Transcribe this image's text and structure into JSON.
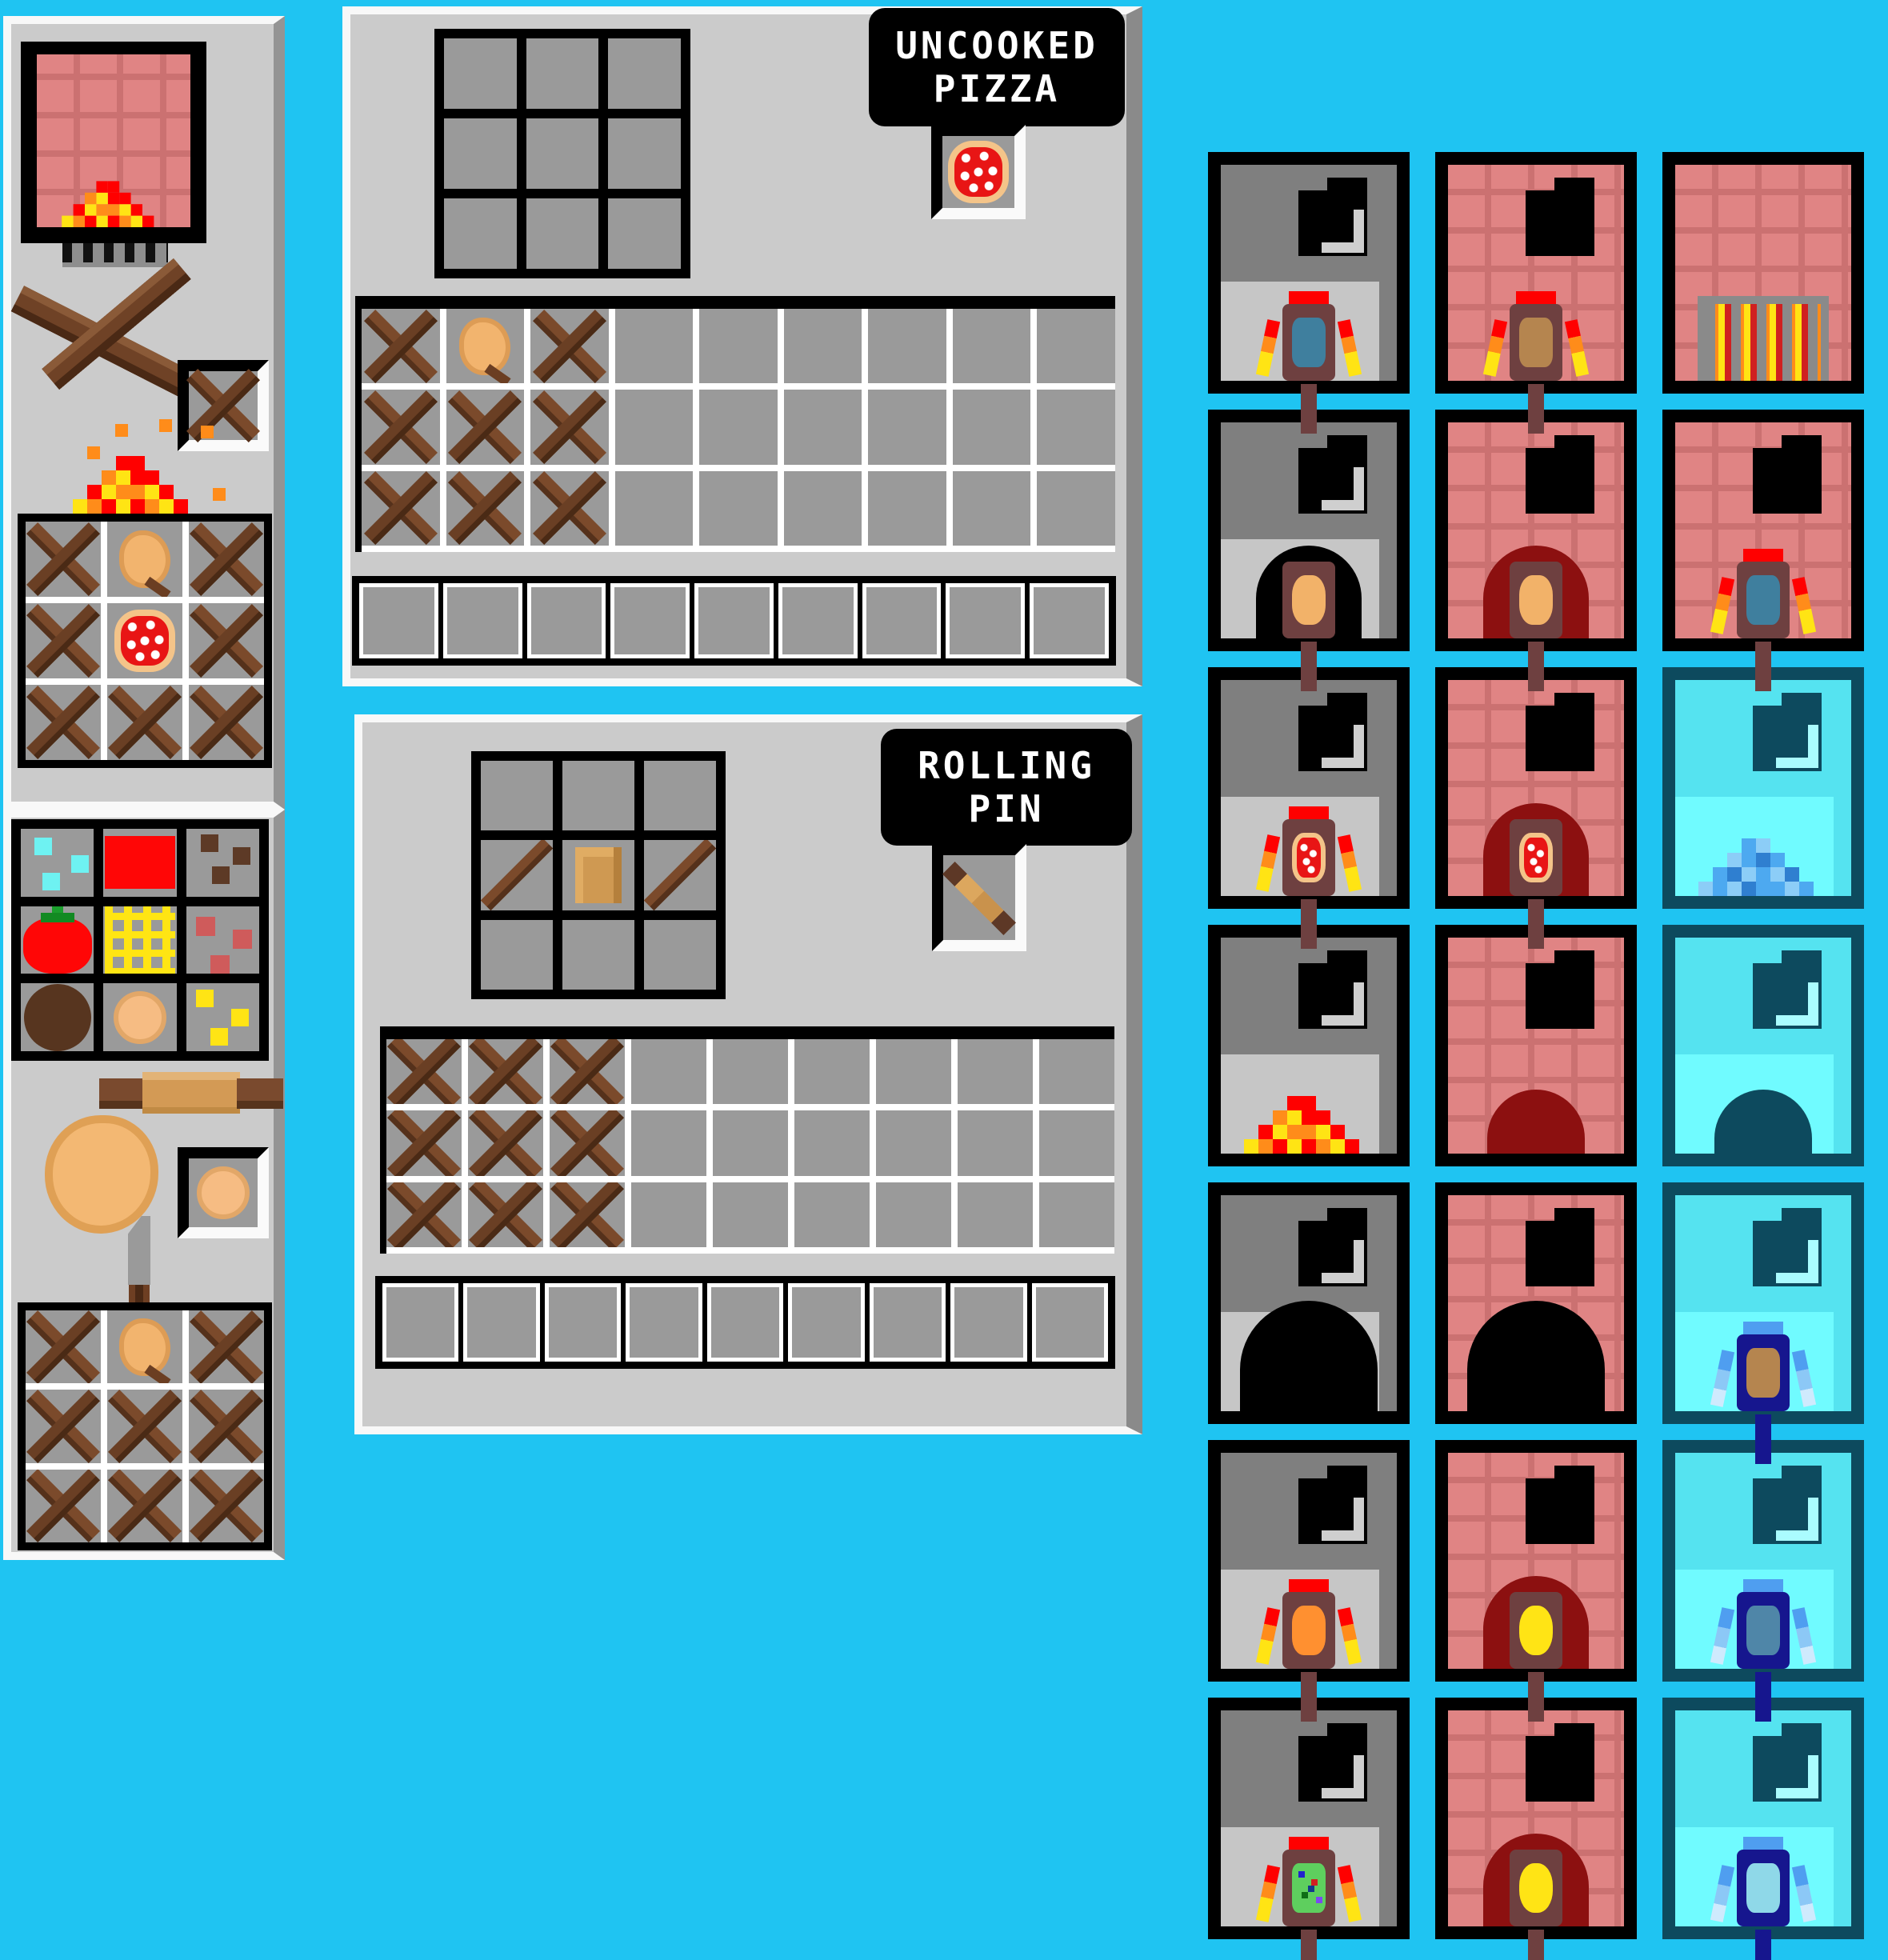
{
  "colors": {
    "background": "#1fc4f2",
    "panel": "#cbcbcb",
    "panel_border_light": "#f8f8f8",
    "panel_shadow": "#949494",
    "slot_gray": "#9a9a9a",
    "brick_body": "#e08484",
    "brick_grout": "#cb7171",
    "fire_red": "#ff0000",
    "fire_orange": "#ff8c1a",
    "fire_yellow": "#ffe414",
    "ice_body": "#55e3f0",
    "ice_frame": "#0d4a5e",
    "navy_paddle": "#16168e",
    "paddle_brown": "#6e4040",
    "maroon_arch": "#8c1010"
  },
  "labels": {
    "pizza_line1": "UNCOOKED",
    "pizza_line2": "PIZZA",
    "pin_line1": "ROLLING",
    "pin_line2": "PIN"
  },
  "left_top_panel": {
    "art": [
      "pizza-oven-with-fire",
      "firewood-sticks",
      "fire"
    ],
    "slot_item": "stick",
    "grid": [
      [
        "stick",
        "dough",
        "stick"
      ],
      [
        "stick",
        "pizza",
        "stick"
      ],
      [
        "stick",
        "stick",
        "stick"
      ]
    ]
  },
  "left_bottom_panel": {
    "ingredients": [
      [
        "cyan-specks",
        "sauce",
        "brown-specks"
      ],
      [
        "tomato",
        "cheese",
        "pepperoni"
      ],
      [
        "chocolate",
        "dough-ball",
        "cheese-bits"
      ]
    ],
    "art": [
      "rolling-pin",
      "dough-blob",
      "knife"
    ],
    "slot_item": "dough-ball",
    "grid": [
      [
        "stick",
        "dough",
        "stick"
      ],
      [
        "stick",
        "stick",
        "stick"
      ],
      [
        "stick",
        "stick",
        "stick"
      ]
    ]
  },
  "pizza_panel": {
    "label": [
      "UNCOOKED",
      "PIZZA"
    ],
    "craft_grid": [
      [
        "",
        "",
        ""
      ],
      [
        "",
        "",
        ""
      ],
      [
        "",
        "",
        ""
      ]
    ],
    "output_item": "pizza",
    "inventory": [
      [
        "stick",
        "dough",
        "stick",
        "",
        "",
        "",
        "",
        "",
        ""
      ],
      [
        "stick",
        "stick",
        "stick",
        "",
        "",
        "",
        "",
        "",
        ""
      ],
      [
        "stick",
        "stick",
        "stick",
        "",
        "",
        "",
        "",
        "",
        ""
      ]
    ],
    "hotbar": [
      "",
      "",
      "",
      "",
      "",
      "",
      "",
      "",
      ""
    ]
  },
  "pin_panel": {
    "label": [
      "ROLLING",
      "PIN"
    ],
    "craft_grid": [
      [
        "",
        "",
        ""
      ],
      [
        "stick1",
        "plank",
        "stick1"
      ],
      [
        "",
        "",
        ""
      ]
    ],
    "output_item": "rollpin",
    "inventory": [
      [
        "stick",
        "stick",
        "stick",
        "",
        "",
        "",
        "",
        "",
        ""
      ],
      [
        "stick",
        "stick",
        "stick",
        "",
        "",
        "",
        "",
        "",
        ""
      ],
      [
        "stick",
        "stick",
        "stick",
        "",
        "",
        "",
        "",
        "",
        ""
      ]
    ],
    "hotbar": [
      "",
      "",
      "",
      "",
      "",
      "",
      "",
      "",
      ""
    ]
  },
  "right_grid": {
    "columns": [
      "gray-oven",
      "brick-oven",
      "ice-oven"
    ],
    "tiles": [
      {
        "oven": "gray",
        "mouth": true,
        "feature": "paddle",
        "item": "blue",
        "side": "flames",
        "handle": true
      },
      {
        "oven": "brick",
        "mouth": true,
        "feature": "paddle",
        "item": "tan",
        "side": "flames",
        "handle": true
      },
      {
        "oven": "brick",
        "mouth": false,
        "feature": "grate",
        "item": "",
        "side": "",
        "handle": false
      },
      {
        "oven": "gray",
        "mouth": true,
        "feature": "paddle",
        "item": "dough",
        "side": "arch-black",
        "handle": true
      },
      {
        "oven": "brick",
        "mouth": true,
        "feature": "paddle",
        "item": "dough",
        "side": "arch-maroon",
        "handle": true
      },
      {
        "oven": "brick",
        "mouth": true,
        "feature": "paddle",
        "item": "blue",
        "side": "flames",
        "handle": true
      },
      {
        "oven": "gray",
        "mouth": true,
        "feature": "paddle",
        "item": "pizza",
        "side": "flames",
        "handle": true
      },
      {
        "oven": "brick",
        "mouth": true,
        "feature": "paddle",
        "item": "pizza",
        "side": "arch-maroon",
        "handle": true
      },
      {
        "oven": "ice",
        "mouth": true,
        "feature": "icepile",
        "item": "",
        "side": "",
        "handle": false
      },
      {
        "oven": "gray",
        "mouth": true,
        "feature": "firepile",
        "item": "",
        "side": "",
        "handle": false
      },
      {
        "oven": "brick",
        "mouth": true,
        "feature": "mound-maroon",
        "item": "",
        "side": "",
        "handle": false
      },
      {
        "oven": "ice",
        "mouth": true,
        "feature": "mound-teal",
        "item": "",
        "side": "",
        "handle": false
      },
      {
        "oven": "gray",
        "mouth": true,
        "feature": "arch-big",
        "item": "",
        "side": "",
        "handle": false
      },
      {
        "oven": "brick",
        "mouth": true,
        "feature": "arch-big",
        "item": "",
        "side": "",
        "handle": false
      },
      {
        "oven": "ice",
        "mouth": true,
        "feature": "paddle-navy",
        "item": "tan",
        "side": "ice",
        "handle": true
      },
      {
        "oven": "gray",
        "mouth": true,
        "feature": "paddle",
        "item": "orange",
        "side": "flames",
        "handle": true
      },
      {
        "oven": "brick",
        "mouth": true,
        "feature": "paddle",
        "item": "yellow",
        "side": "arch-maroon",
        "handle": true
      },
      {
        "oven": "ice",
        "mouth": true,
        "feature": "paddle-navy",
        "item": "steel",
        "side": "ice",
        "handle": true
      },
      {
        "oven": "gray",
        "mouth": true,
        "feature": "paddle",
        "item": "green",
        "side": "flames",
        "handle": true
      },
      {
        "oven": "brick",
        "mouth": true,
        "feature": "paddle",
        "item": "yellow",
        "side": "arch-maroon",
        "handle": true
      },
      {
        "oven": "ice",
        "mouth": true,
        "feature": "paddle-navy",
        "item": "cyan",
        "side": "ice",
        "handle": true
      }
    ]
  }
}
